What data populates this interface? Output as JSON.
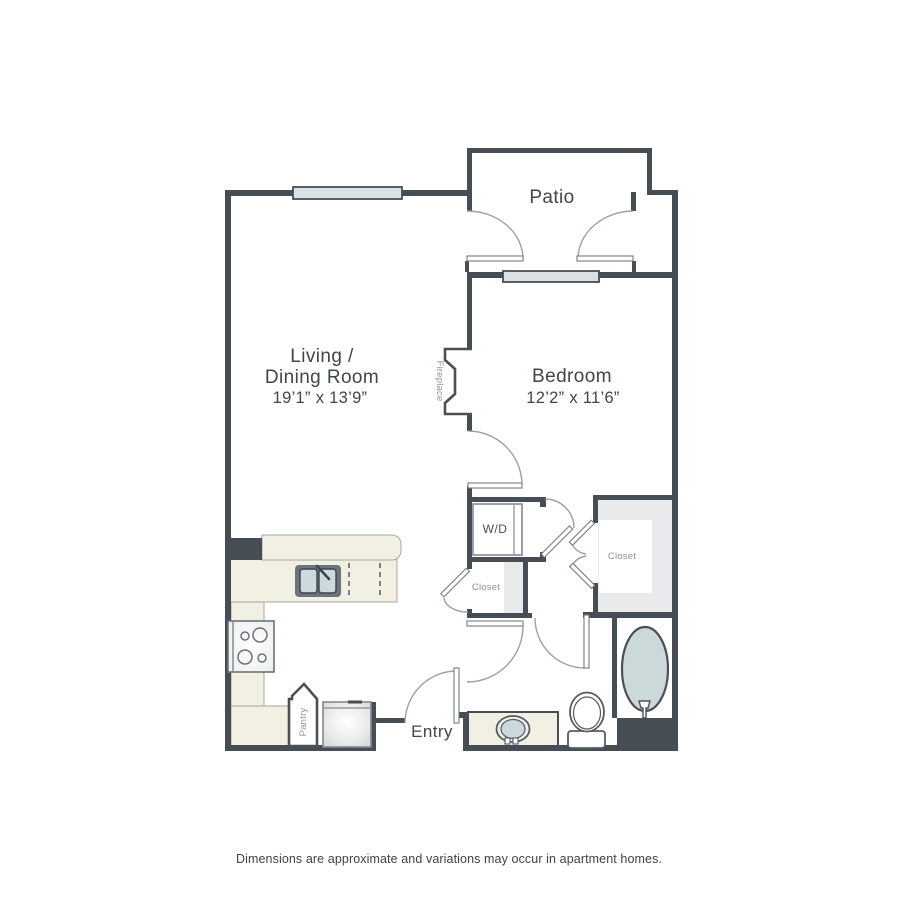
{
  "plan": {
    "rooms": {
      "patio": {
        "label": "Patio"
      },
      "living": {
        "line1": "Living /",
        "line2": "Dining Room",
        "dims": "19’1” x 13’9”"
      },
      "bedroom": {
        "label": "Bedroom",
        "dims": "12’2” x 11’6”"
      },
      "entry": {
        "label": "Entry"
      }
    },
    "fixtures": {
      "washer_dryer": "W/D",
      "hall_closet": "Closet",
      "bedroom_closet": "Closet",
      "pantry": "Pantry",
      "fireplace": "Fireplace"
    },
    "colors": {
      "wall": "#474d55",
      "counter_cream": "#f2f0e3",
      "closet_gray": "#e8eaec",
      "water_blue": "#ccd9dc",
      "window_fill": "#dbe0e3",
      "door_line": "#8a9096",
      "label_dark": "#41464c",
      "label_gray": "#8d9399"
    }
  },
  "footer": {
    "disclaimer": "Dimensions are approximate and variations may occur in apartment homes."
  }
}
